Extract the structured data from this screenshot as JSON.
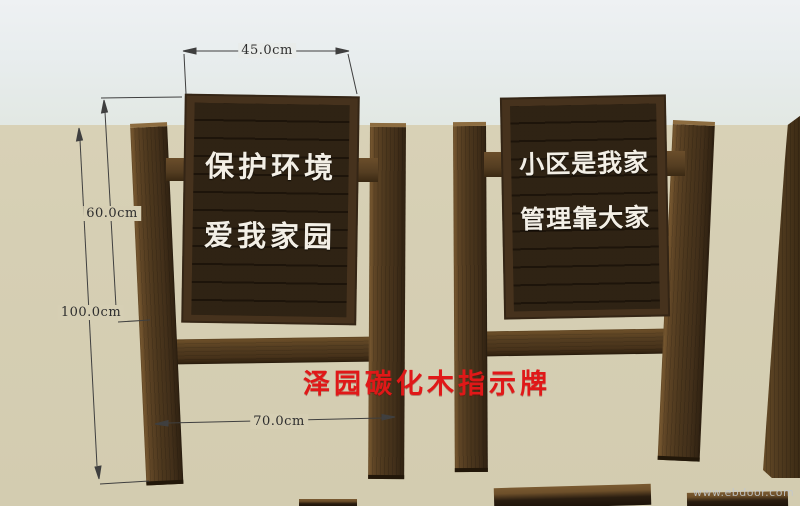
{
  "annotation": {
    "title": "泽园碳化木指示牌"
  },
  "signs": {
    "left_board": {
      "line1": "保护环境",
      "line2": "爱我家园"
    },
    "right_board": {
      "line1": "小区是我家",
      "line2": "管理靠大家"
    }
  },
  "dimensions": {
    "board_width": "45.0cm",
    "board_height": "60.0cm",
    "post_height": "100.0cm",
    "post_spacing": "70.0cm"
  },
  "watermark": "www.ebdoor.com",
  "colors": {
    "title_red": "#e01818",
    "sky_top": "#eef1f3",
    "sky_horizon": "#e2e8e3",
    "ground": "#d6cfb4",
    "wood_post": "#4c371d",
    "wood_board_frame": "#46321d",
    "wood_board_planks": "#2b1f12",
    "sign_text": "#f3efe6",
    "dimension_line": "#3f3f3f"
  }
}
